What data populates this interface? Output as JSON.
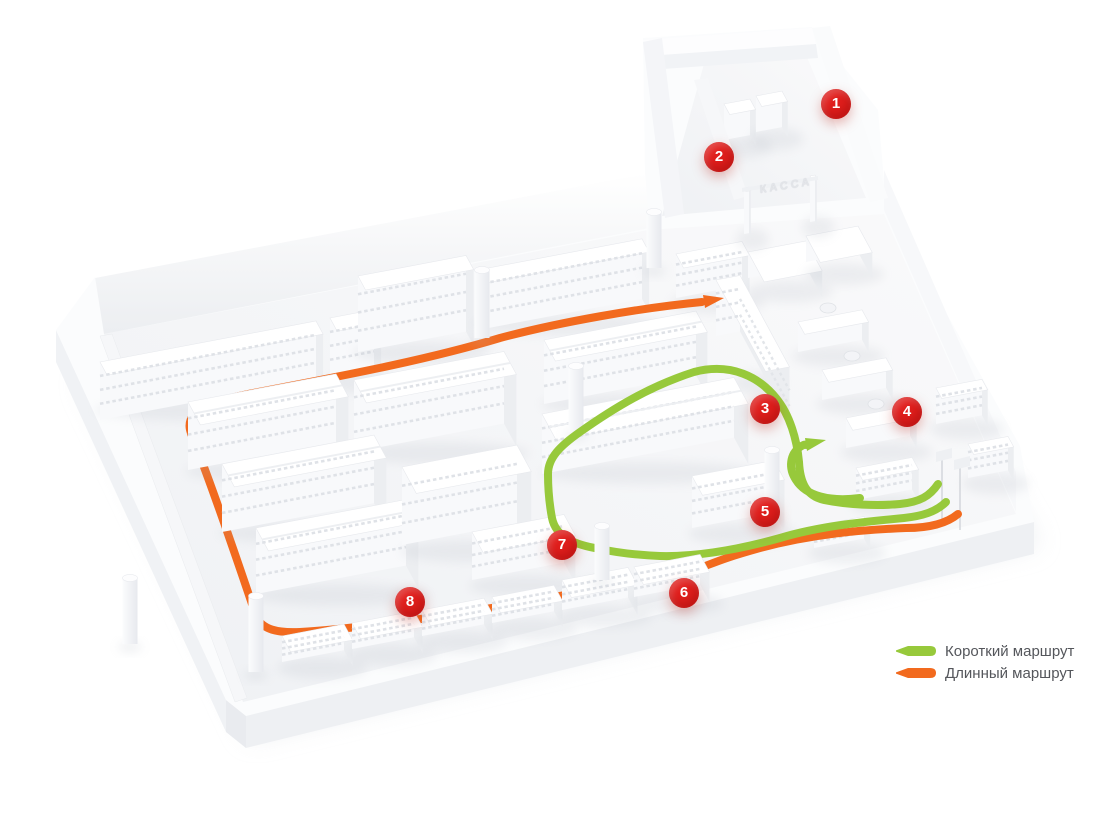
{
  "scene": {
    "description": "3D isometric supermarket floor plan with numbered route points",
    "kassa_sign": "КАССА"
  },
  "markers": [
    {
      "number": "1",
      "x": 836,
      "y": 104
    },
    {
      "number": "2",
      "x": 719,
      "y": 157
    },
    {
      "number": "3",
      "x": 765,
      "y": 409
    },
    {
      "number": "4",
      "x": 907,
      "y": 412
    },
    {
      "number": "5",
      "x": 765,
      "y": 512
    },
    {
      "number": "6",
      "x": 684,
      "y": 593
    },
    {
      "number": "7",
      "x": 562,
      "y": 545
    },
    {
      "number": "8",
      "x": 410,
      "y": 602
    }
  ],
  "legend": {
    "items": [
      {
        "id": "short-route",
        "label": "Короткий маршрут",
        "color": "#97c93b"
      },
      {
        "id": "long-route",
        "label": "Длинный маршрут",
        "color": "#f26a1e"
      }
    ]
  },
  "colors": {
    "marker_red": "#e01e1c",
    "route_short": "#97c93b",
    "route_long": "#f26a1e",
    "legend_text": "#54565b",
    "floor_light": "#fafafb",
    "floor_dark": "#eff1f4"
  }
}
